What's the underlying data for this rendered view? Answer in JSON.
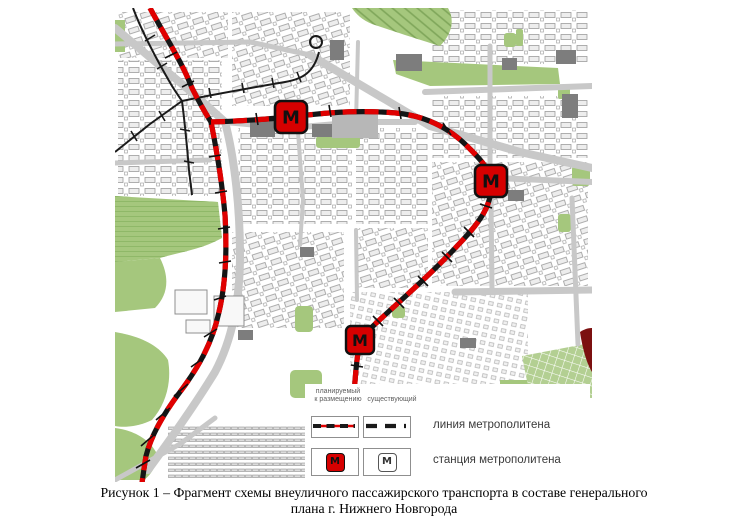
{
  "figure": {
    "caption_line1": "Рисунок 1 – Фрагмент схемы внеуличного пассажирского транспорта в составе генерального",
    "caption_line2": "плана г. Нижнего Новгорода"
  },
  "map": {
    "stations": [
      {
        "label": "М"
      },
      {
        "label": "М"
      },
      {
        "label": "М"
      }
    ]
  },
  "legend": {
    "col1_header_line1": "планируемый",
    "col1_header_line2": "к размещению",
    "col2_header": "существующий",
    "row1_label": "линия метрополитена",
    "row2_label": "станция метрополитена",
    "planned_station_symbol": "М",
    "existing_station_symbol": "М"
  },
  "colors": {
    "planned_line_red": "#e00000",
    "existing_line_black": "#1a1a1a",
    "station_fill_red": "#d60000",
    "park_green": "#a5c77d",
    "road_gray": "#c8c8c8",
    "stadium_dark_red": "#7c1010"
  }
}
